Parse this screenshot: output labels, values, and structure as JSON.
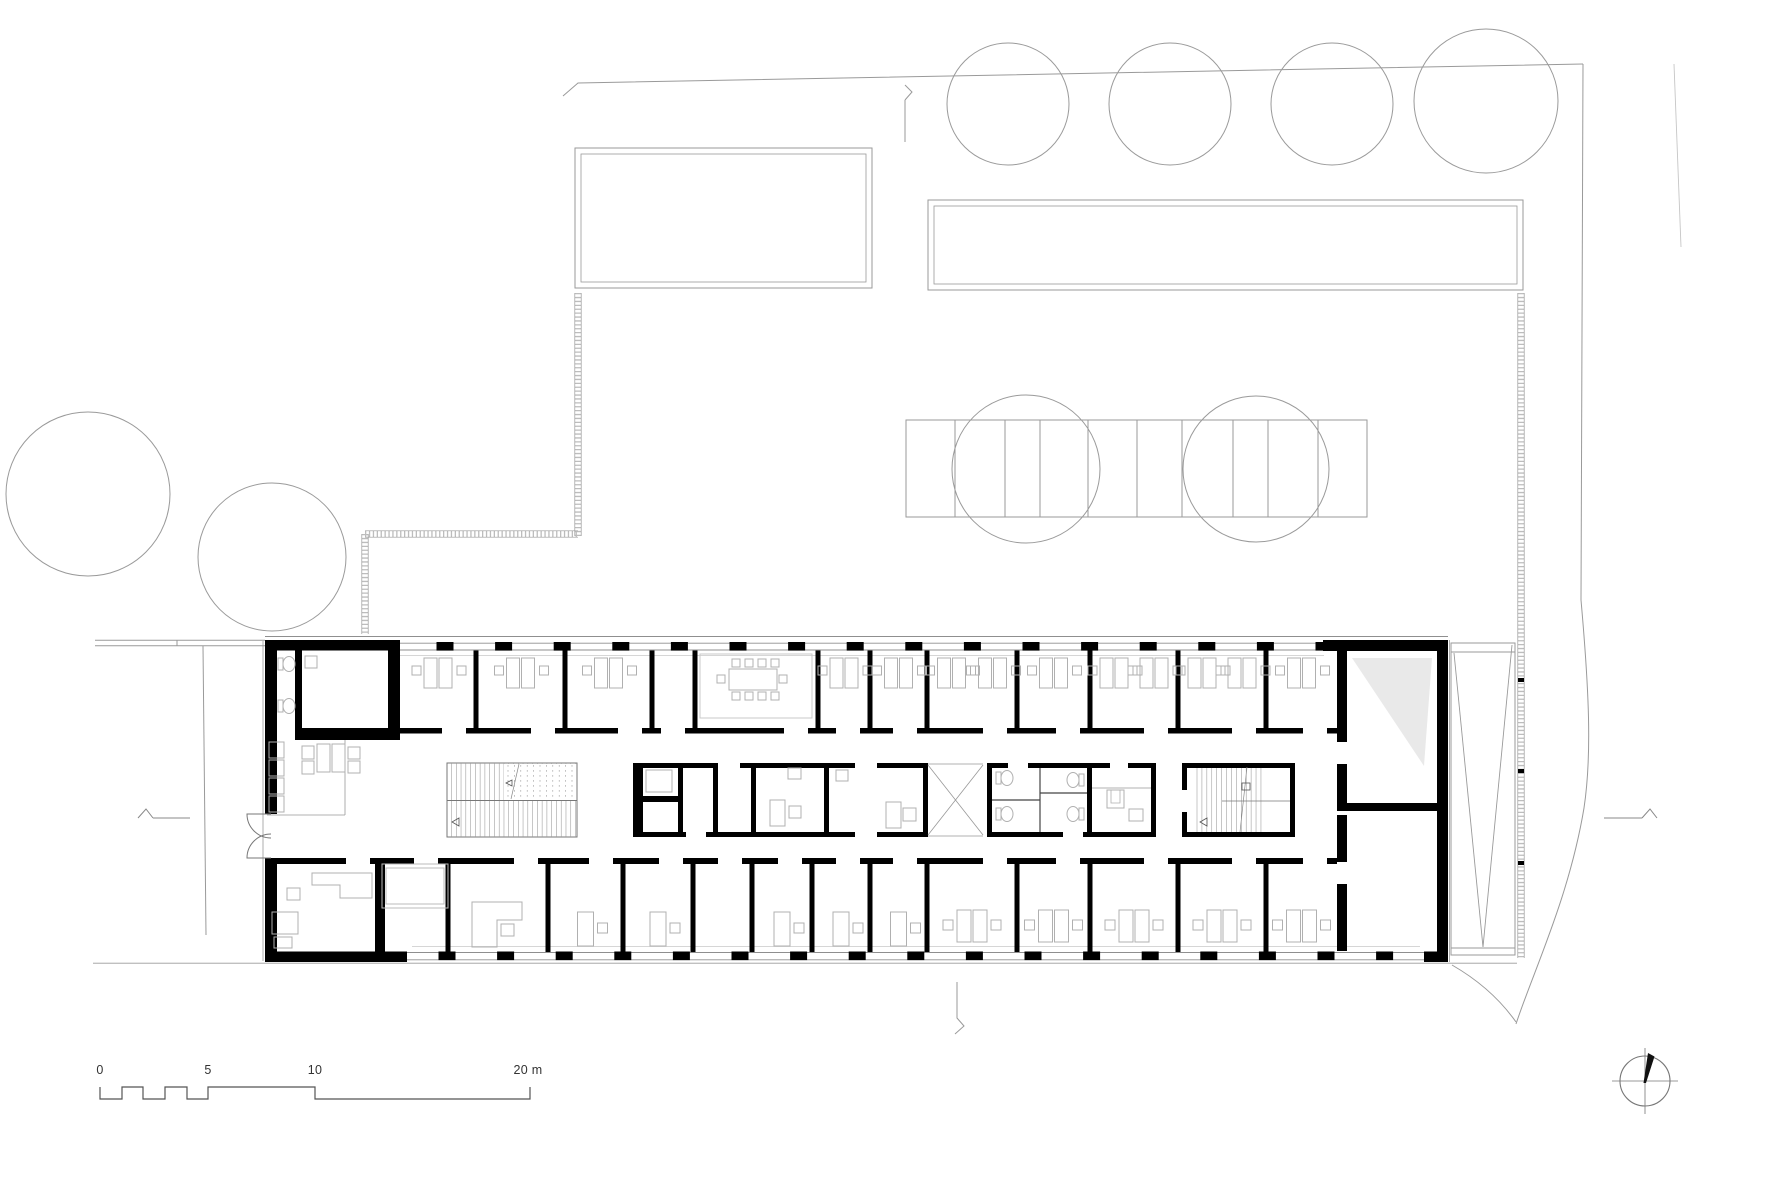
{
  "title": "office building ground floor plan",
  "colors": {
    "background": "#ffffff",
    "site_line": "#9a9a9a",
    "faint_line": "#c6c6c6",
    "wall": "#000000",
    "furniture": "#b0b0b0",
    "glass": "#c9c9c9",
    "shade": "#e9e9e9",
    "thin_wall": "#444444",
    "stair_line": "#999999",
    "scale_line": "#555555",
    "hatch": "#bdbdbd",
    "text": "#333333"
  },
  "scale_bar": {
    "unit": "m",
    "labels": [
      "0",
      "5",
      "10",
      "20 m"
    ],
    "tick_values_m": [
      0,
      5,
      10,
      20
    ]
  },
  "north_arrow": {
    "icon": "compass-north-icon",
    "direction": "up-right"
  },
  "site": {
    "trees_top": [
      [
        1008,
        104,
        61
      ],
      [
        1170,
        104,
        61
      ],
      [
        1332,
        104,
        61
      ],
      [
        1486,
        101,
        72
      ]
    ],
    "trees_left": [
      [
        88,
        494,
        82
      ],
      [
        272,
        557,
        74
      ]
    ],
    "trees_parking": [
      [
        1026,
        469,
        74
      ],
      [
        1256,
        469,
        73
      ]
    ],
    "parking": {
      "x": 906,
      "y": 420,
      "w": 461,
      "h": 97,
      "dividers": [
        955,
        1005,
        1040,
        1088,
        1137,
        1182,
        1233,
        1268,
        1318
      ]
    },
    "block_top_left": [
      575,
      148,
      297,
      140
    ],
    "block_top_right": [
      928,
      200,
      595,
      90
    ]
  },
  "building": {
    "bbox": [
      265,
      634,
      1183,
      328
    ],
    "top_rooms": [
      400,
      476,
      565,
      652,
      695,
      818,
      870,
      927,
      1017,
      1090,
      1178,
      1266,
      1337
    ],
    "bottom_rooms": [
      267,
      380,
      448,
      548,
      623,
      693,
      752,
      812,
      870,
      927,
      1017,
      1090,
      1178,
      1266,
      1337
    ],
    "pier_start_top": 445,
    "pier_start_bottom": 447,
    "pier_step": 58.6,
    "pier_count_top": 16,
    "pier_count_bottom": 17,
    "top_room_kinds": [
      "pair",
      "pair",
      "pair",
      "none",
      "meeting",
      "pair",
      "pair",
      "pair2",
      "pair",
      "pair2",
      "pair2",
      "pair"
    ],
    "bottom_room_kinds": [
      "office-large",
      "glass-box",
      "counter-L",
      "single",
      "single",
      "none",
      "single",
      "single",
      "single",
      "pair",
      "pair",
      "pair",
      "pair",
      "pair"
    ]
  }
}
